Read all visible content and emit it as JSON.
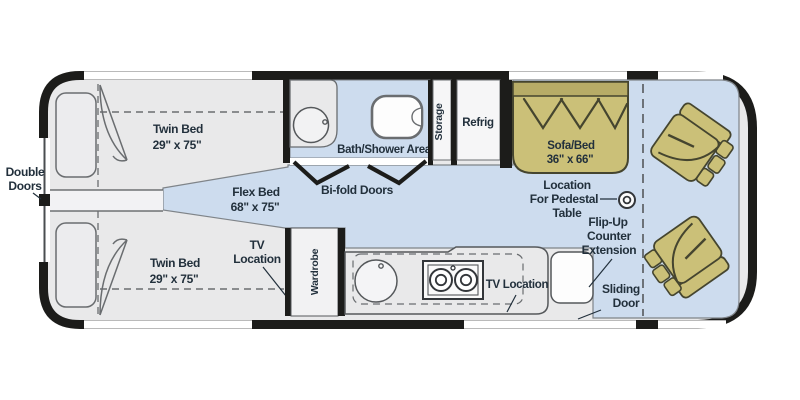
{
  "diagram": {
    "type": "rv-motorhome-floorplan"
  },
  "colors": {
    "floor_blue": "#cddcee",
    "furniture_olive": "#cbc078",
    "furniture_olive_dark": "#b7ac67",
    "body_black": "#1c1c1a",
    "interior_gray": "#e9e9ea",
    "label_text": "#22303c"
  },
  "labels": {
    "double_doors": {
      "line1": "Double",
      "line2": "Doors"
    },
    "twin_bed_top": {
      "name": "Twin Bed",
      "dims": "29\" x 75\""
    },
    "twin_bed_bottom": {
      "name": "Twin Bed",
      "dims": "29\" x 75\""
    },
    "flex_bed": {
      "name": "Flex Bed",
      "dims": "68\" x 75\""
    },
    "tv_location_bedroom": {
      "line1": "TV",
      "line2": "Location"
    },
    "bath_shower": "Bath/Shower Area",
    "bifold_doors": "Bi-fold Doors",
    "storage": "Storage",
    "refrig": "Refrig",
    "wardrobe": "Wardrobe",
    "sofa_bed": {
      "name": "Sofa/Bed",
      "dims": "36\" x 66\""
    },
    "pedestal_table": {
      "line1": "Location",
      "line2": "For Pedestal",
      "line3": "Table"
    },
    "flip_up_counter": {
      "line1": "Flip-Up",
      "line2": "Counter",
      "line3": "Extension"
    },
    "tv_location_galley": "TV Location",
    "sliding_door": {
      "line1": "Sliding",
      "line2": "Door"
    }
  }
}
